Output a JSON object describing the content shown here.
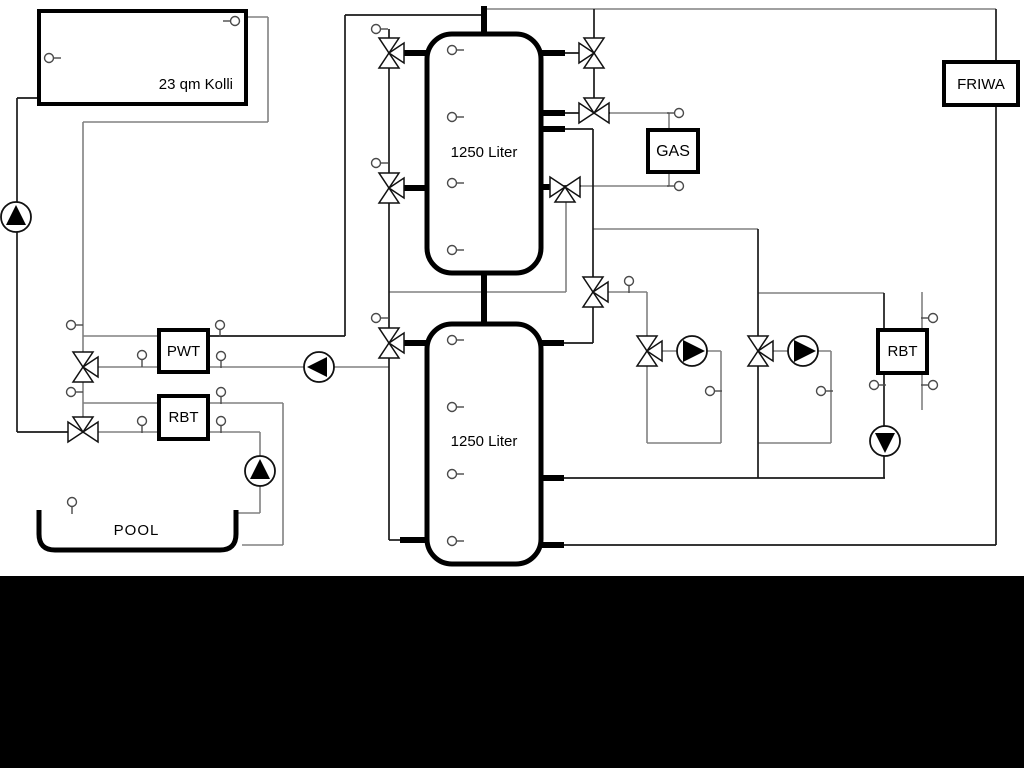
{
  "diagram": {
    "labels": {
      "collector": "23 qm Kolli",
      "upper_tank": "1250 Liter",
      "lower_tank": "1250 Liter",
      "pwt": "PWT",
      "rbt_pool": "RBT",
      "gas": "GAS",
      "friwa": "FRIWA",
      "rbt_heating": "RBT",
      "pool": "POOL"
    },
    "colors": {
      "background": "#ffffff",
      "letterbox": "#000000",
      "pipe_gray": "#808080",
      "pipe_dark": "#1a1a1a",
      "outline": "#000000"
    }
  }
}
